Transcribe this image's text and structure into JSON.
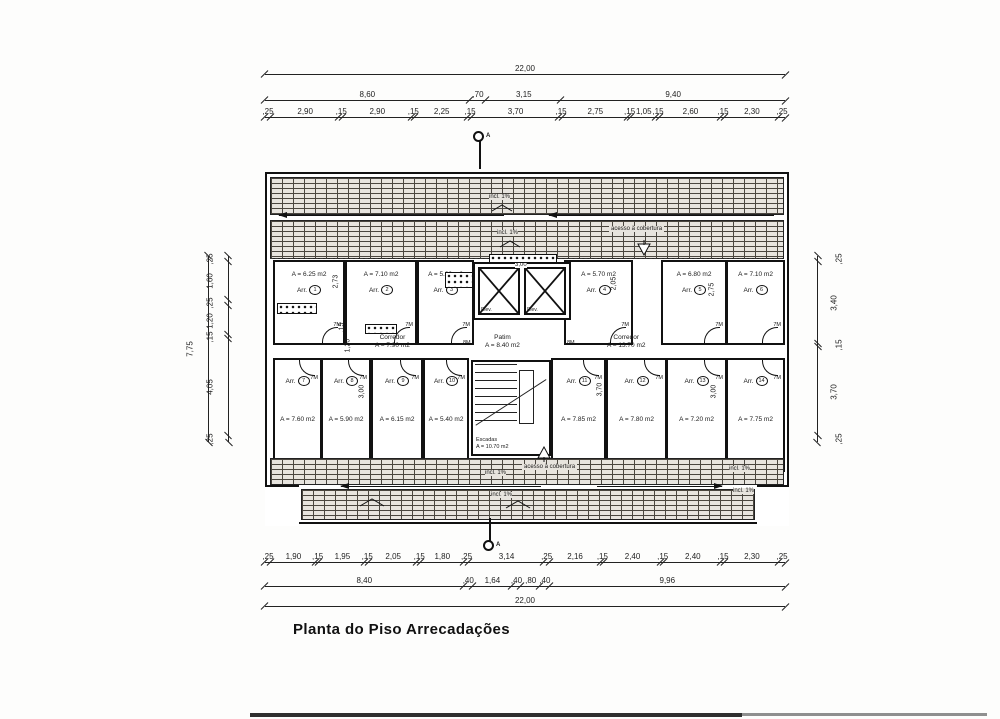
{
  "title": "Planta do Piso Arrecadações",
  "section_marker": "A",
  "dims": {
    "top": [
      [
        "22,00"
      ],
      [
        "8,60",
        ",70",
        "3,15",
        "9,40"
      ],
      [
        ",25",
        "2,90",
        ",15",
        "2,90",
        ",15",
        "2,25",
        ",15",
        "3,70",
        ",15",
        "2,75",
        ",15",
        "1,05",
        ",15",
        "2,60",
        ",15",
        "2,30",
        ",25"
      ]
    ],
    "bottom": [
      [
        ",25",
        "1,90",
        ",15",
        "1,95",
        ",15",
        "2,05",
        ",15",
        "1,80",
        ",25",
        "3,14",
        ",25",
        "2,16",
        ",15",
        "2,40",
        ",15",
        "2,40",
        ",15",
        "2,30",
        ",25"
      ],
      [
        "8,40",
        ",40",
        "1,64",
        ",40",
        ",80",
        ",40",
        "9,96"
      ],
      [
        "22,00"
      ]
    ],
    "left_total": [
      [
        "7,75"
      ]
    ],
    "left_segs": [
      [
        ",25",
        "1,60",
        ",25",
        "1,20",
        ",15",
        "4,05",
        ",25"
      ]
    ],
    "right_segs": [
      [
        ",25",
        "3,40",
        ",15",
        "3,70",
        ",25"
      ]
    ]
  },
  "rooms": [
    {
      "label": "Arr.",
      "num": "1",
      "area": "A = 6.25 m2"
    },
    {
      "label": "Arr.",
      "num": "2",
      "area": "A = 7.10 m2"
    },
    {
      "label": "Arr.",
      "num": "3",
      "area": "A = 5.80 m2"
    },
    {
      "label": "Arr.",
      "num": "4",
      "area": "A = 5.70 m2"
    },
    {
      "label": "Arr.",
      "num": "5",
      "area": "A = 6.80 m2"
    },
    {
      "label": "Arr.",
      "num": "6",
      "area": "A = 7.10 m2"
    },
    {
      "label": "Arr.",
      "num": "7",
      "area": "A = 7.60 m2"
    },
    {
      "label": "Arr.",
      "num": "8",
      "area": "A = 5.90 m2"
    },
    {
      "label": "Arr.",
      "num": "9",
      "area": "A = 6.15 m2"
    },
    {
      "label": "Arr.",
      "num": "10",
      "area": "A = 5.40 m2"
    },
    {
      "label": "Arr.",
      "num": "11",
      "area": "A = 7.85 m2"
    },
    {
      "label": "Arr.",
      "num": "12",
      "area": "A = 7.80 m2"
    },
    {
      "label": "Arr.",
      "num": "13",
      "area": "A = 7.20 m2"
    },
    {
      "label": "Arr.",
      "num": "14",
      "area": "A = 7.75 m2"
    }
  ],
  "spaces": {
    "corredor_left": {
      "name": "Corredor",
      "area": "A = 7.90 m2"
    },
    "corredor_right": {
      "name": "Corredor",
      "area": "A = 13.70 m2"
    },
    "patim": {
      "name": "Patim",
      "area": "A = 8.40 m2"
    },
    "escadas": {
      "name": "Escadas",
      "area": "A = 10.70 m2"
    },
    "elevator": "Elev."
  },
  "annotations": {
    "incl": "incl. 1%",
    "acesso": "acesso à cobertura"
  },
  "door_tags": {
    "room": "7M",
    "hall": "8M"
  },
  "inner_dims": [
    "2,73",
    "2,05",
    "2,75",
    "3,00",
    ",15",
    "1,20",
    "3,00",
    "3,70",
    "3,00"
  ]
}
